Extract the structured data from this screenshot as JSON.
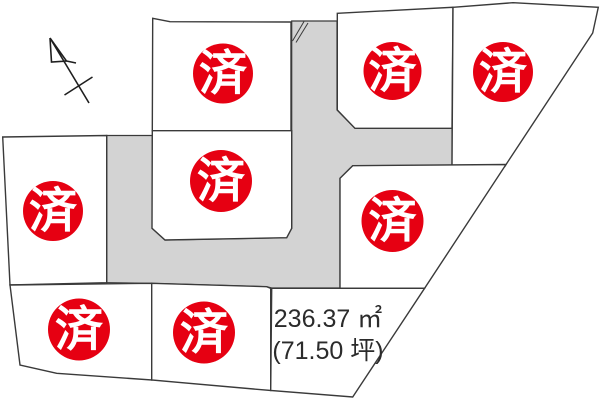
{
  "map": {
    "background_color": "#ffffff",
    "outline_color": "#3a3a3a",
    "road_color": "#d3d3d3",
    "plot_fill": "#ffffff",
    "sold_badge_color": "#e60012",
    "sold_badge_text_color": "#ffffff",
    "available_fill": "#fbfbd9",
    "north_arrow": {
      "d": "M50 38 L89 103 M50 38 L51.5 62 L66.5 61 L50 38 M66.5 61 L76 63 M64.5 95 L92.5 77"
    },
    "road": {
      "points": "106.7,135.5 152.3,135.5 152.3,228.3 165,240 286.7,237.7 291.7,228.3 291.7,21 337,21 337,110 355,128.3 452,128.3 452,166.7 352.7,165.7 340,178.3 340,288 271.7,288 266.7,286.7 151.7,283.3 110,282.7 106.7,282.7",
      "mark1": {
        "x1": 304,
        "y1": 21.5,
        "x2": 292.5,
        "y2": 41
      },
      "mark2": {
        "x1": 308,
        "y1": 23,
        "x2": 296,
        "y2": 42.5
      }
    },
    "plots": [
      {
        "id": "plot-1",
        "status": "sold",
        "label": "済",
        "points": "152.7,18.3 170,21.7 291,22 291,130.7 152.3,130.7",
        "badge": {
          "cx": 223,
          "cy": 73.5,
          "r": 30,
          "ty": 89.5
        }
      },
      {
        "id": "plot-2",
        "status": "sold",
        "label": "済",
        "points": "152.3,130.7 291.7,130.7 291.7,228.3 286.7,237.7 165,240 152,228.3",
        "badge": {
          "cx": 221,
          "cy": 181,
          "r": 31,
          "ty": 197
        }
      },
      {
        "id": "plot-3",
        "status": "sold",
        "label": "済",
        "points": "337.3,13.3 453,7.3 452,128.3 355,128.3 337.3,110",
        "badge": {
          "cx": 392.5,
          "cy": 71,
          "r": 29,
          "ty": 87
        }
      },
      {
        "id": "plot-4",
        "status": "sold",
        "label": "済",
        "points": "453,7.3 513,2.7 598.3,7.3 592.7,33 504.6,166.7 452,166.7",
        "badge": {
          "cx": 503,
          "cy": 72,
          "r": 30,
          "ty": 88
        }
      },
      {
        "id": "plot-5",
        "status": "sold",
        "label": "済",
        "points": "2.7,137 106.7,135.5 106.7,282.7 10,285",
        "badge": {
          "cx": 53,
          "cy": 211,
          "r": 30,
          "ty": 227
        }
      },
      {
        "id": "plot-6",
        "status": "sold",
        "label": "済",
        "points": "352.7,165.7 506,164.5 424.6,288.3 340,288.3 340,178.3",
        "badge": {
          "cx": 392.5,
          "cy": 221,
          "r": 31,
          "ty": 237
        }
      },
      {
        "id": "plot-7",
        "status": "sold",
        "label": "済",
        "points": "10,285 151.7,283.3 151.7,380 56.7,373.3 20,365",
        "badge": {
          "cx": 79,
          "cy": 329.5,
          "r": 31,
          "ty": 345.5
        }
      },
      {
        "id": "plot-8",
        "status": "sold",
        "label": "済",
        "points": "151.7,283.3 266.7,286.7 270.7,288.3 270.7,390.5 151.7,380",
        "badge": {
          "cx": 204,
          "cy": 332.5,
          "r": 31,
          "ty": 348.5
        }
      },
      {
        "id": "plot-9",
        "status": "available",
        "points": "271.7,288.3 424.6,288.3 352.7,397 270.7,390.5",
        "area_m2": "236.37 ㎡",
        "area_tsubo": "(71.50 坪)",
        "text": {
          "x": 328,
          "y1": 327,
          "y2": 359
        }
      }
    ]
  }
}
